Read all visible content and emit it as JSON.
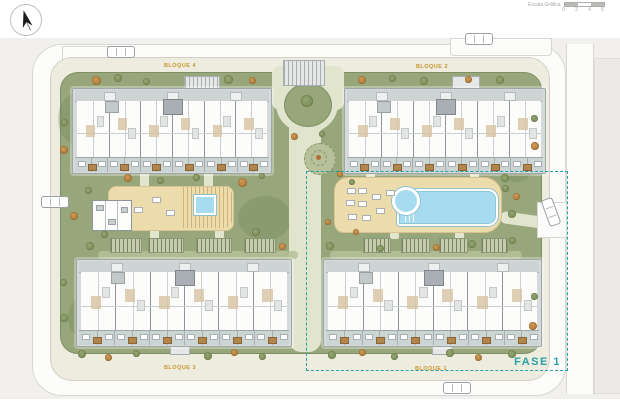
{
  "header": {
    "scale_bar": {
      "label": "Escala Gráfica",
      "ticks": [
        "0",
        "2",
        "4",
        "6"
      ]
    },
    "compass_icon": "north-arrow-icon"
  },
  "plan": {
    "phase": {
      "label": "FASE 1"
    },
    "buildings": [
      {
        "id": "bloque-4",
        "label": "BLOQUE 4",
        "x": 72,
        "y": 88,
        "w": 198,
        "h": 84,
        "units": 6,
        "lx": 180,
        "ly": 66
      },
      {
        "id": "bloque-2",
        "label": "BLOQUE 2",
        "x": 344,
        "y": 88,
        "w": 200,
        "h": 84,
        "units": 6,
        "lx": 432,
        "ly": 67
      },
      {
        "id": "bloque-3",
        "label": "BLOQUE 3",
        "x": 76,
        "y": 259,
        "w": 214,
        "h": 86,
        "units": 6,
        "lx": 180,
        "ly": 368
      },
      {
        "id": "bloque-1",
        "label": "BLOQUE 1",
        "x": 323,
        "y": 259,
        "w": 217,
        "h": 86,
        "units": 6,
        "lx": 431,
        "ly": 369
      }
    ],
    "colors": {
      "context": "#f1f0ee",
      "road": "#fcfcfb",
      "curb": "#d9d7d2",
      "walkway": "#edecdf",
      "green": "#98a67c",
      "green_edge": "#7d8f63",
      "path": "#e2e5cd",
      "deck": "#eddcab",
      "deck_edge": "#d8c291",
      "pool": "#a7dbf0",
      "pool_edge": "#8fc0d4",
      "plate": "#d5dbda",
      "plate_edge": "#a0a6a8",
      "interior": "#fcfcfb",
      "wall": "#8e959a",
      "wall_light": "#c9ced0",
      "balcony": "#cbd5d4",
      "planter": "#b2854b",
      "core": "#a9afb4",
      "room": "#d8c5a6",
      "pergola_base": "#c6cbae",
      "pergola_line": "#75845c",
      "grass_light": "#b6bf99",
      "tree_green": "#7e925d",
      "tree_orange": "#bf7c37",
      "fase": "#2aa0a5",
      "label": "#c8952d"
    },
    "trees": [
      [
        96,
        80,
        9,
        "o"
      ],
      [
        118,
        78,
        8,
        "g"
      ],
      [
        146,
        81,
        7,
        "g"
      ],
      [
        228,
        79,
        9,
        "g"
      ],
      [
        252,
        80,
        7,
        "o"
      ],
      [
        362,
        80,
        8,
        "o"
      ],
      [
        392,
        78,
        7,
        "g"
      ],
      [
        424,
        81,
        8,
        "g"
      ],
      [
        468,
        79,
        7,
        "o"
      ],
      [
        500,
        80,
        8,
        "g"
      ],
      [
        128,
        178,
        8,
        "o"
      ],
      [
        160,
        180,
        7,
        "g"
      ],
      [
        196,
        177,
        7,
        "g"
      ],
      [
        242,
        182,
        9,
        "o"
      ],
      [
        262,
        176,
        6,
        "g"
      ],
      [
        340,
        174,
        6,
        "o"
      ],
      [
        352,
        182,
        6,
        "g"
      ],
      [
        505,
        178,
        8,
        "g"
      ],
      [
        516,
        196,
        7,
        "o"
      ],
      [
        512,
        214,
        8,
        "g"
      ],
      [
        88,
        190,
        7,
        "g"
      ],
      [
        74,
        216,
        8,
        "o"
      ],
      [
        90,
        246,
        8,
        "g"
      ],
      [
        307,
        101,
        12,
        "g"
      ],
      [
        294,
        136,
        7,
        "o"
      ],
      [
        322,
        134,
        6,
        "g"
      ],
      [
        104,
        234,
        7,
        "g"
      ],
      [
        256,
        232,
        8,
        "g"
      ],
      [
        282,
        246,
        7,
        "o"
      ],
      [
        330,
        246,
        8,
        "g"
      ],
      [
        356,
        232,
        6,
        "o"
      ],
      [
        380,
        248,
        7,
        "g"
      ],
      [
        436,
        247,
        7,
        "o"
      ],
      [
        472,
        244,
        8,
        "g"
      ],
      [
        512,
        240,
        7,
        "g"
      ],
      [
        82,
        354,
        8,
        "g"
      ],
      [
        108,
        357,
        7,
        "o"
      ],
      [
        136,
        353,
        7,
        "g"
      ],
      [
        208,
        356,
        8,
        "g"
      ],
      [
        234,
        352,
        7,
        "o"
      ],
      [
        262,
        356,
        7,
        "g"
      ],
      [
        332,
        355,
        8,
        "g"
      ],
      [
        362,
        352,
        7,
        "o"
      ],
      [
        394,
        356,
        7,
        "g"
      ],
      [
        450,
        353,
        8,
        "g"
      ],
      [
        478,
        357,
        7,
        "o"
      ],
      [
        512,
        354,
        8,
        "g"
      ],
      [
        64,
        122,
        7,
        "g"
      ],
      [
        64,
        150,
        8,
        "o"
      ],
      [
        63,
        282,
        7,
        "g"
      ],
      [
        64,
        318,
        8,
        "g"
      ],
      [
        534,
        118,
        7,
        "g"
      ],
      [
        535,
        146,
        8,
        "o"
      ],
      [
        534,
        296,
        7,
        "g"
      ],
      [
        533,
        326,
        8,
        "o"
      ],
      [
        328,
        222,
        6,
        "o"
      ],
      [
        505,
        188,
        7,
        "g"
      ]
    ],
    "cars": [
      {
        "x": 121,
        "y": 52,
        "r": 0
      },
      {
        "x": 479,
        "y": 39,
        "r": 0
      },
      {
        "x": 55,
        "y": 202,
        "r": 0
      },
      {
        "x": 551,
        "y": 212,
        "r": 70
      },
      {
        "x": 457,
        "y": 388,
        "r": 180
      }
    ],
    "pergolas": [
      [
        110,
        238,
        30
      ],
      [
        148,
        238,
        34
      ],
      [
        196,
        238,
        34
      ],
      [
        244,
        238,
        30
      ],
      [
        363,
        238,
        26
      ],
      [
        401,
        238,
        27
      ],
      [
        439,
        238,
        27
      ],
      [
        481,
        238,
        25
      ]
    ],
    "loungers": [
      [
        347,
        188
      ],
      [
        358,
        188
      ],
      [
        346,
        200
      ],
      [
        358,
        201
      ],
      [
        372,
        194
      ],
      [
        348,
        214
      ],
      [
        362,
        215
      ],
      [
        376,
        208
      ],
      [
        386,
        190
      ],
      [
        152,
        197
      ],
      [
        166,
        210
      ],
      [
        134,
        207
      ]
    ],
    "connectors": [
      [
        140,
        172,
        9,
        16
      ],
      [
        204,
        172,
        9,
        16
      ],
      [
        366,
        172,
        9,
        7
      ],
      [
        470,
        172,
        9,
        7
      ],
      [
        150,
        229,
        9,
        10
      ],
      [
        215,
        229,
        9,
        10
      ],
      [
        390,
        231,
        9,
        8
      ],
      [
        455,
        231,
        9,
        8
      ]
    ],
    "stubs": [
      [
        184,
        76,
        34,
        13,
        "striped"
      ],
      [
        452,
        76,
        26,
        13,
        "plain"
      ],
      [
        170,
        345,
        18,
        8,
        "plain"
      ],
      [
        432,
        345,
        18,
        8,
        "plain"
      ],
      [
        283,
        60,
        40,
        24,
        "striped"
      ]
    ],
    "grass_strips": [
      [
        98,
        251,
        200,
        8
      ],
      [
        330,
        251,
        192,
        8
      ]
    ],
    "blobs": [
      [
        58,
        92,
        44,
        54
      ],
      [
        492,
        118,
        48,
        64
      ],
      [
        68,
        296,
        38,
        44
      ],
      [
        502,
        276,
        38,
        52
      ],
      [
        238,
        196,
        54,
        44
      ],
      [
        96,
        120,
        60,
        40
      ]
    ]
  }
}
